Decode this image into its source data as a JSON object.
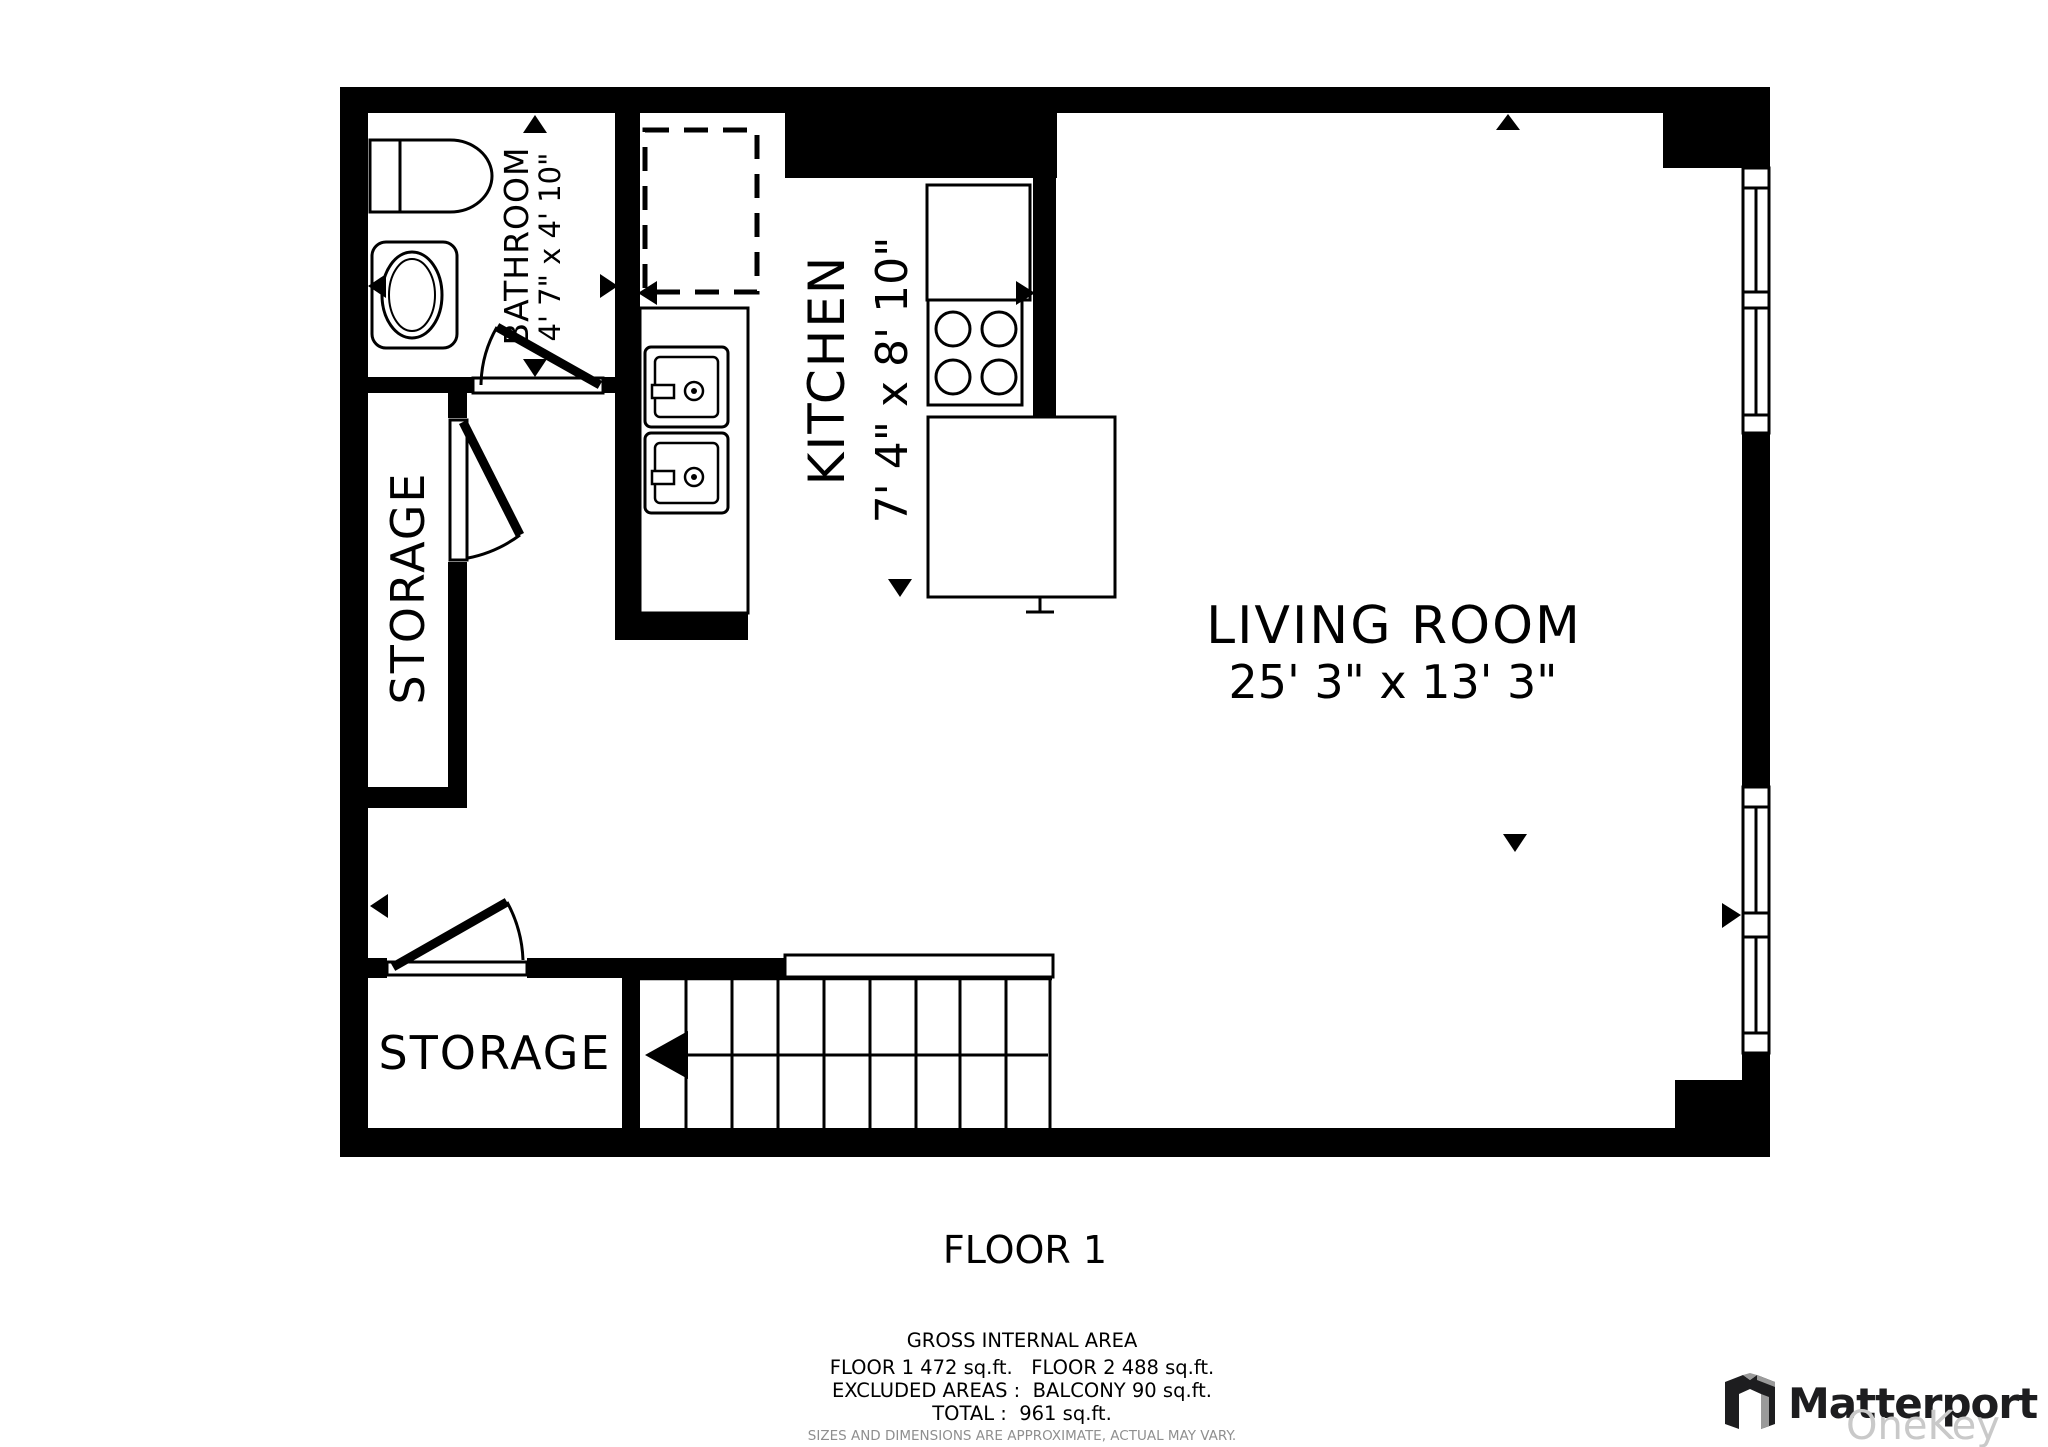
{
  "plan": {
    "floor_label": "FLOOR 1",
    "rooms": {
      "bathroom": {
        "name": "BATHROOM",
        "dims": "4' 7\" x 4' 10\""
      },
      "kitchen": {
        "name": "KITCHEN",
        "dims": "7' 4\" x 8' 10\""
      },
      "living_room": {
        "name": "LIVING ROOM",
        "dims": "25' 3\" x 13' 3\""
      },
      "storage_left": {
        "name": "STORAGE"
      },
      "storage_bottom": {
        "name": "STORAGE"
      }
    }
  },
  "area_summary": {
    "title": "GROSS INTERNAL AREA",
    "floors_line": "FLOOR 1 472 sq.ft.   FLOOR 2 488 sq.ft.",
    "excluded_line": "EXCLUDED AREAS :  BALCONY 90 sq.ft.",
    "total_line": "TOTAL :  961 sq.ft.",
    "disclaimer": "SIZES AND DIMENSIONS ARE APPROXIMATE, ACTUAL MAY VARY."
  },
  "branding": {
    "logo_text": "Matterport",
    "watermark": "OneKey MLS"
  },
  "colors": {
    "wall": "#000000",
    "background": "#ffffff",
    "disclaimer_gray": "#8f8f8f",
    "watermark_gray": "#c9c9c9",
    "logo_dark": "#1d1d1f",
    "logo_gray": "#9a9a9a"
  }
}
